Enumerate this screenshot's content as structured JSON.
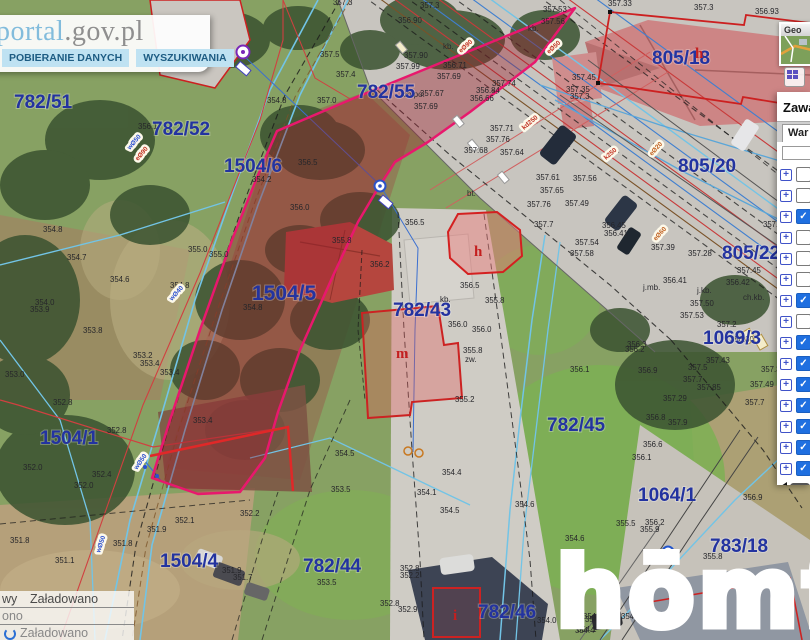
{
  "header": {
    "logo_blue": "portal",
    "logo_gray": ".gov.pl",
    "buttons": [
      {
        "label": "POBIERANIE DANYCH"
      },
      {
        "label": "WYSZUKIWANIA"
      }
    ]
  },
  "sidebar": {
    "minimap_title": "Geo",
    "panel_title": "Zawa",
    "tab_label": "War",
    "layers": [
      {
        "checked": false
      },
      {
        "checked": false
      },
      {
        "checked": true
      },
      {
        "checked": false
      },
      {
        "checked": false
      },
      {
        "checked": false
      },
      {
        "checked": true
      },
      {
        "checked": false
      },
      {
        "checked": true
      },
      {
        "checked": true
      },
      {
        "checked": true
      },
      {
        "checked": true
      },
      {
        "checked": true
      },
      {
        "checked": true
      },
      {
        "checked": true
      }
    ]
  },
  "status_panel": {
    "rows": [
      {
        "c1": "wy",
        "c2": "Załadowano"
      },
      {
        "c1": "ono",
        "c2": ""
      },
      {
        "c1": "",
        "c2": "Załadowano"
      }
    ]
  },
  "watermark": "hōmfi",
  "colors": {
    "parcel_number": "#2333a0",
    "highlight_outline": "#e8186d",
    "highlight_fill": "rgba(155,30,45,0.4)",
    "checkbox_checked": "#1f6fe0",
    "header_logo_blue": "#82bcdc",
    "building_outline_red": "#cc2222"
  },
  "map": {
    "parcels": [
      {
        "x": 14,
        "y": 108,
        "id": "782/51"
      },
      {
        "x": 152,
        "y": 135,
        "id": "782/52"
      },
      {
        "x": 224,
        "y": 172,
        "id": "1504/6"
      },
      {
        "x": 252,
        "y": 300,
        "id": "1504/5",
        "big": true
      },
      {
        "x": 40,
        "y": 444,
        "id": "1504/1"
      },
      {
        "x": 160,
        "y": 567,
        "id": "1504/4"
      },
      {
        "x": 303,
        "y": 572,
        "id": "782/44"
      },
      {
        "x": 357,
        "y": 98,
        "id": "782/55"
      },
      {
        "x": 393,
        "y": 316,
        "id": "782/43"
      },
      {
        "x": 652,
        "y": 64,
        "id": "805/18"
      },
      {
        "x": 678,
        "y": 172,
        "id": "805/20"
      },
      {
        "x": 722,
        "y": 259,
        "id": "805/22"
      },
      {
        "x": 703,
        "y": 344,
        "id": "1069/3"
      },
      {
        "x": 547,
        "y": 431,
        "id": "782/45"
      },
      {
        "x": 638,
        "y": 501,
        "id": "1064/1"
      },
      {
        "x": 710,
        "y": 552,
        "id": "783/18"
      },
      {
        "x": 478,
        "y": 618,
        "id": "782/46"
      }
    ],
    "building_letters": [
      {
        "x": 695,
        "y": 58,
        "t": "h",
        "s": 15
      },
      {
        "x": 474,
        "y": 256,
        "t": "h",
        "s": 16
      },
      {
        "x": 396,
        "y": 358,
        "t": "m",
        "s": 19
      },
      {
        "x": 453,
        "y": 620,
        "t": "i",
        "s": 15
      }
    ],
    "road_labels": [
      {
        "x": 403,
        "y": 97,
        "t": "ch.po."
      },
      {
        "x": 443,
        "y": 49,
        "t": "kb."
      },
      {
        "x": 528,
        "y": 31,
        "t": "kb."
      },
      {
        "x": 643,
        "y": 290,
        "t": "j.mb."
      },
      {
        "x": 697,
        "y": 293,
        "t": "j.kb."
      },
      {
        "x": 743,
        "y": 300,
        "t": "ch.kb."
      },
      {
        "x": 440,
        "y": 302,
        "t": "kb."
      },
      {
        "x": 465,
        "y": 362,
        "t": "zw."
      },
      {
        "x": 467,
        "y": 196,
        "t": "bt."
      }
    ],
    "utility_labels": [
      {
        "x": 130,
        "y": 150,
        "t": "wØ50",
        "c": "#2b4fd0",
        "r": -50
      },
      {
        "x": 138,
        "y": 161,
        "t": "eØ90",
        "c": "#c03020",
        "r": -50
      },
      {
        "x": 172,
        "y": 301,
        "t": "wØ40",
        "c": "#2b4fd0",
        "r": -48
      },
      {
        "x": 461,
        "y": 53,
        "t": "eØ90",
        "c": "#c03020",
        "r": -42
      },
      {
        "x": 549,
        "y": 54,
        "t": "eØ50",
        "c": "#c03020",
        "r": -42
      },
      {
        "x": 524,
        "y": 130,
        "t": "kd250",
        "c": "#c03020",
        "r": -40
      },
      {
        "x": 606,
        "y": 160,
        "t": "k250",
        "c": "#c03020",
        "r": -40
      },
      {
        "x": 652,
        "y": 156,
        "t": "eØ20",
        "c": "#c06020",
        "r": -48
      },
      {
        "x": 656,
        "y": 241,
        "t": "eØ60",
        "c": "#c06020",
        "r": -48
      },
      {
        "x": 137,
        "y": 470,
        "t": "wØ50",
        "c": "#2b4fd0",
        "r": -55
      },
      {
        "x": 100,
        "y": 553,
        "t": "wØ50",
        "c": "#2b4fd0",
        "r": -72
      }
    ],
    "elevations": [
      [
        320,
        57,
        "357.5"
      ],
      [
        333,
        5,
        "357.3"
      ],
      [
        420,
        8,
        "357.3"
      ],
      [
        398,
        23,
        "356.90"
      ],
      [
        404,
        58,
        "357.90"
      ],
      [
        396,
        69,
        "357.99"
      ],
      [
        443,
        68,
        "356.71"
      ],
      [
        437,
        79,
        "357.69"
      ],
      [
        420,
        96,
        "357.67"
      ],
      [
        414,
        109,
        "357.69"
      ],
      [
        470,
        101,
        "356.66"
      ],
      [
        476,
        93,
        "356.84"
      ],
      [
        492,
        86,
        "357.74"
      ],
      [
        543,
        12,
        "357.53"
      ],
      [
        541,
        24,
        "357.56"
      ],
      [
        336,
        77,
        "357.4"
      ],
      [
        267,
        103,
        "354.8"
      ],
      [
        317,
        103,
        "357.0"
      ],
      [
        298,
        165,
        "356.5"
      ],
      [
        252,
        182,
        "354.2"
      ],
      [
        290,
        210,
        "356.0"
      ],
      [
        332,
        243,
        "355.8"
      ],
      [
        188,
        252,
        "355.0"
      ],
      [
        209,
        257,
        "355.0"
      ],
      [
        243,
        310,
        "354.8"
      ],
      [
        138,
        129,
        "356.1"
      ],
      [
        43,
        232,
        "354.8"
      ],
      [
        67,
        260,
        "354.7"
      ],
      [
        110,
        282,
        "354.6"
      ],
      [
        170,
        288,
        "354.8"
      ],
      [
        35,
        305,
        "354.0"
      ],
      [
        30,
        312,
        "353.9"
      ],
      [
        83,
        333,
        "353.8"
      ],
      [
        133,
        358,
        "353.2"
      ],
      [
        140,
        366,
        "353.4"
      ],
      [
        160,
        375,
        "353.4"
      ],
      [
        5,
        377,
        "353.0"
      ],
      [
        53,
        405,
        "352.8"
      ],
      [
        107,
        433,
        "352.8"
      ],
      [
        193,
        423,
        "353.4"
      ],
      [
        23,
        470,
        "352.0"
      ],
      [
        92,
        477,
        "352.4"
      ],
      [
        74,
        488,
        "352.0"
      ],
      [
        10,
        543,
        "351.8"
      ],
      [
        113,
        546,
        "351.8"
      ],
      [
        55,
        563,
        "351.1"
      ],
      [
        147,
        532,
        "351.9"
      ],
      [
        175,
        523,
        "352.1"
      ],
      [
        240,
        516,
        "352.2"
      ],
      [
        222,
        573,
        "351.9"
      ],
      [
        233,
        580,
        "351.7"
      ],
      [
        572,
        80,
        "357.45"
      ],
      [
        566,
        92,
        "357.35"
      ],
      [
        570,
        99,
        "357.3"
      ],
      [
        608,
        6,
        "357.33"
      ],
      [
        694,
        10,
        "357.3"
      ],
      [
        755,
        14,
        "356.93"
      ],
      [
        490,
        131,
        "357.71"
      ],
      [
        486,
        142,
        "357.76"
      ],
      [
        464,
        153,
        "357.68"
      ],
      [
        500,
        155,
        "357.64"
      ],
      [
        536,
        180,
        "357.61"
      ],
      [
        573,
        181,
        "357.56"
      ],
      [
        540,
        193,
        "357.65"
      ],
      [
        527,
        207,
        "357.76"
      ],
      [
        565,
        206,
        "357.49"
      ],
      [
        534,
        227,
        "357.7"
      ],
      [
        575,
        245,
        "357.54"
      ],
      [
        570,
        256,
        "357.58"
      ],
      [
        602,
        228,
        "356.45"
      ],
      [
        604,
        236,
        "356.41"
      ],
      [
        651,
        250,
        "357.39"
      ],
      [
        688,
        256,
        "357.28"
      ],
      [
        663,
        283,
        "356.41"
      ],
      [
        726,
        285,
        "356.42"
      ],
      [
        737,
        273,
        "357.45"
      ],
      [
        690,
        306,
        "357.50"
      ],
      [
        680,
        318,
        "357.53"
      ],
      [
        717,
        327,
        "357.2"
      ],
      [
        763,
        227,
        "357.42"
      ],
      [
        730,
        342,
        "356.30"
      ],
      [
        627,
        347,
        "356.3"
      ],
      [
        405,
        225,
        "356.5"
      ],
      [
        370,
        267,
        "356.2"
      ],
      [
        460,
        288,
        "356.5"
      ],
      [
        485,
        303,
        "355.8"
      ],
      [
        448,
        327,
        "356.0"
      ],
      [
        472,
        332,
        "356.0"
      ],
      [
        463,
        353,
        "355.8"
      ],
      [
        455,
        402,
        "355.2"
      ],
      [
        335,
        456,
        "354.5"
      ],
      [
        331,
        492,
        "353.5"
      ],
      [
        417,
        495,
        "354.1"
      ],
      [
        440,
        513,
        "354.5"
      ],
      [
        442,
        475,
        "354.4"
      ],
      [
        515,
        507,
        "354.6"
      ],
      [
        317,
        585,
        "353.5"
      ],
      [
        380,
        606,
        "352.8"
      ],
      [
        398,
        612,
        "352.9"
      ],
      [
        570,
        372,
        "356.1"
      ],
      [
        638,
        373,
        "356.9"
      ],
      [
        625,
        352,
        "356.2"
      ],
      [
        706,
        363,
        "357.43"
      ],
      [
        688,
        370,
        "357.5"
      ],
      [
        761,
        372,
        "357.37"
      ],
      [
        683,
        382,
        "357.7"
      ],
      [
        750,
        387,
        "357.49"
      ],
      [
        697,
        390,
        "357.85"
      ],
      [
        663,
        401,
        "357.29"
      ],
      [
        745,
        405,
        "357.7"
      ],
      [
        646,
        420,
        "356.8"
      ],
      [
        668,
        425,
        "357.9"
      ],
      [
        643,
        447,
        "356.6"
      ],
      [
        632,
        460,
        "356.1"
      ],
      [
        743,
        500,
        "356.9"
      ],
      [
        645,
        525,
        "356.2"
      ],
      [
        616,
        526,
        "355.5"
      ],
      [
        640,
        532,
        "355.9"
      ],
      [
        565,
        541,
        "354.6"
      ],
      [
        703,
        559,
        "355.8"
      ],
      [
        583,
        619,
        "354.3"
      ],
      [
        621,
        619,
        "354.7"
      ],
      [
        575,
        633,
        "354.4"
      ],
      [
        400,
        571,
        "352.8"
      ],
      [
        400,
        578,
        "352.2"
      ],
      [
        537,
        623,
        "354.0"
      ],
      [
        585,
        622,
        "354.3"
      ],
      [
        577,
        632,
        "354.1"
      ]
    ]
  }
}
